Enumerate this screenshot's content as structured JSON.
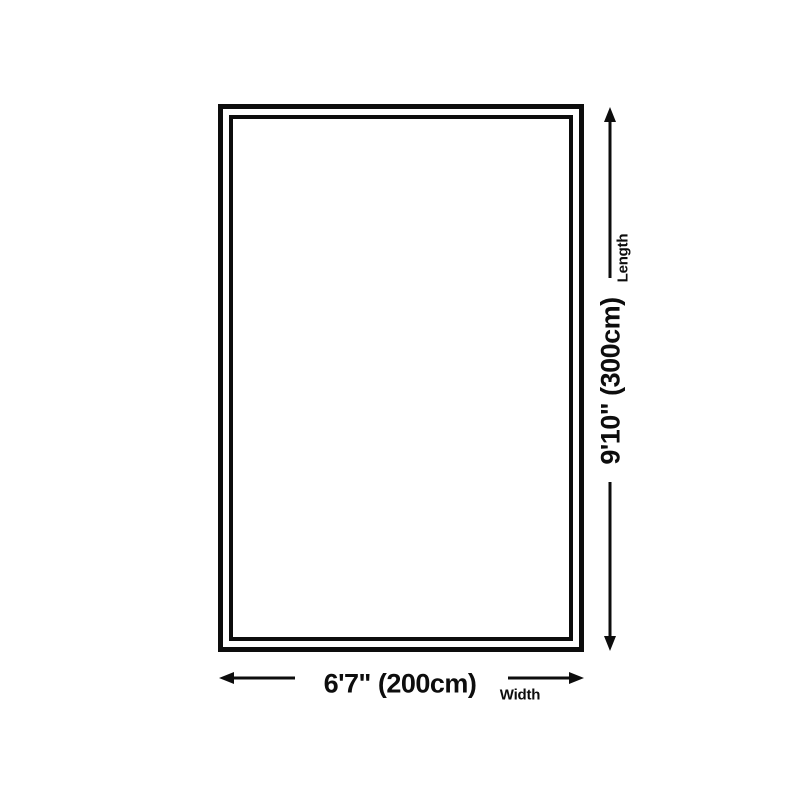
{
  "colors": {
    "line": "#0d0d0d",
    "background": "#ffffff"
  },
  "diagram": {
    "length": {
      "value": "9'10\" (300cm)",
      "label": "Length"
    },
    "width": {
      "value": "6'7\" (200cm)",
      "label": "Width"
    }
  }
}
